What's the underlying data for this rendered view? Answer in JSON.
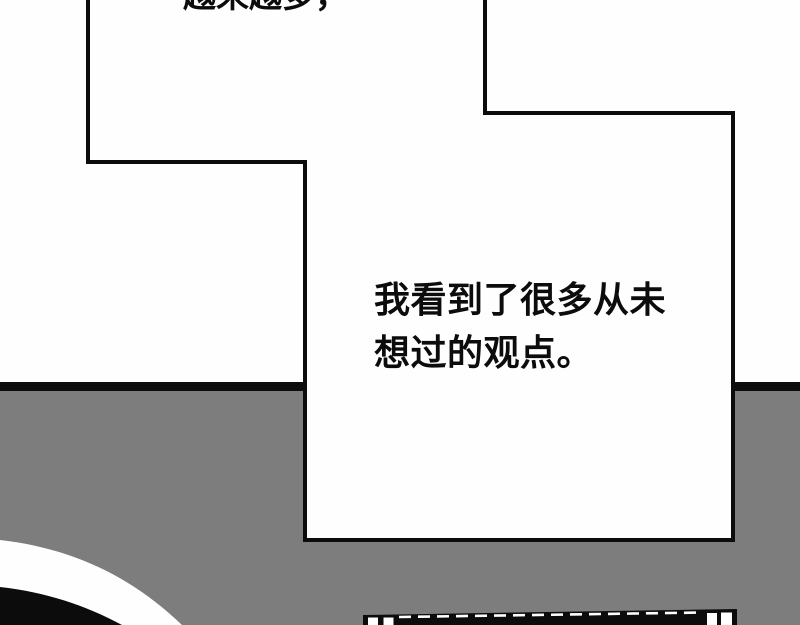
{
  "page": {
    "kind": "comic-page"
  },
  "colors": {
    "page_bg": "#fefefe",
    "gutter_gray": "#7d7d7d",
    "ink": "#0c0c0c",
    "panel_white": "#fefefe"
  },
  "dialogue": {
    "top_caption": "越来越多，",
    "narration_lines": [
      "我看到了很多从未",
      "想过的观点。"
    ]
  },
  "decor": {
    "bottom_left_shape": "black-disc-with-white-ring",
    "bottom_center_shape": "black-shelf-top-with-white-panes"
  }
}
